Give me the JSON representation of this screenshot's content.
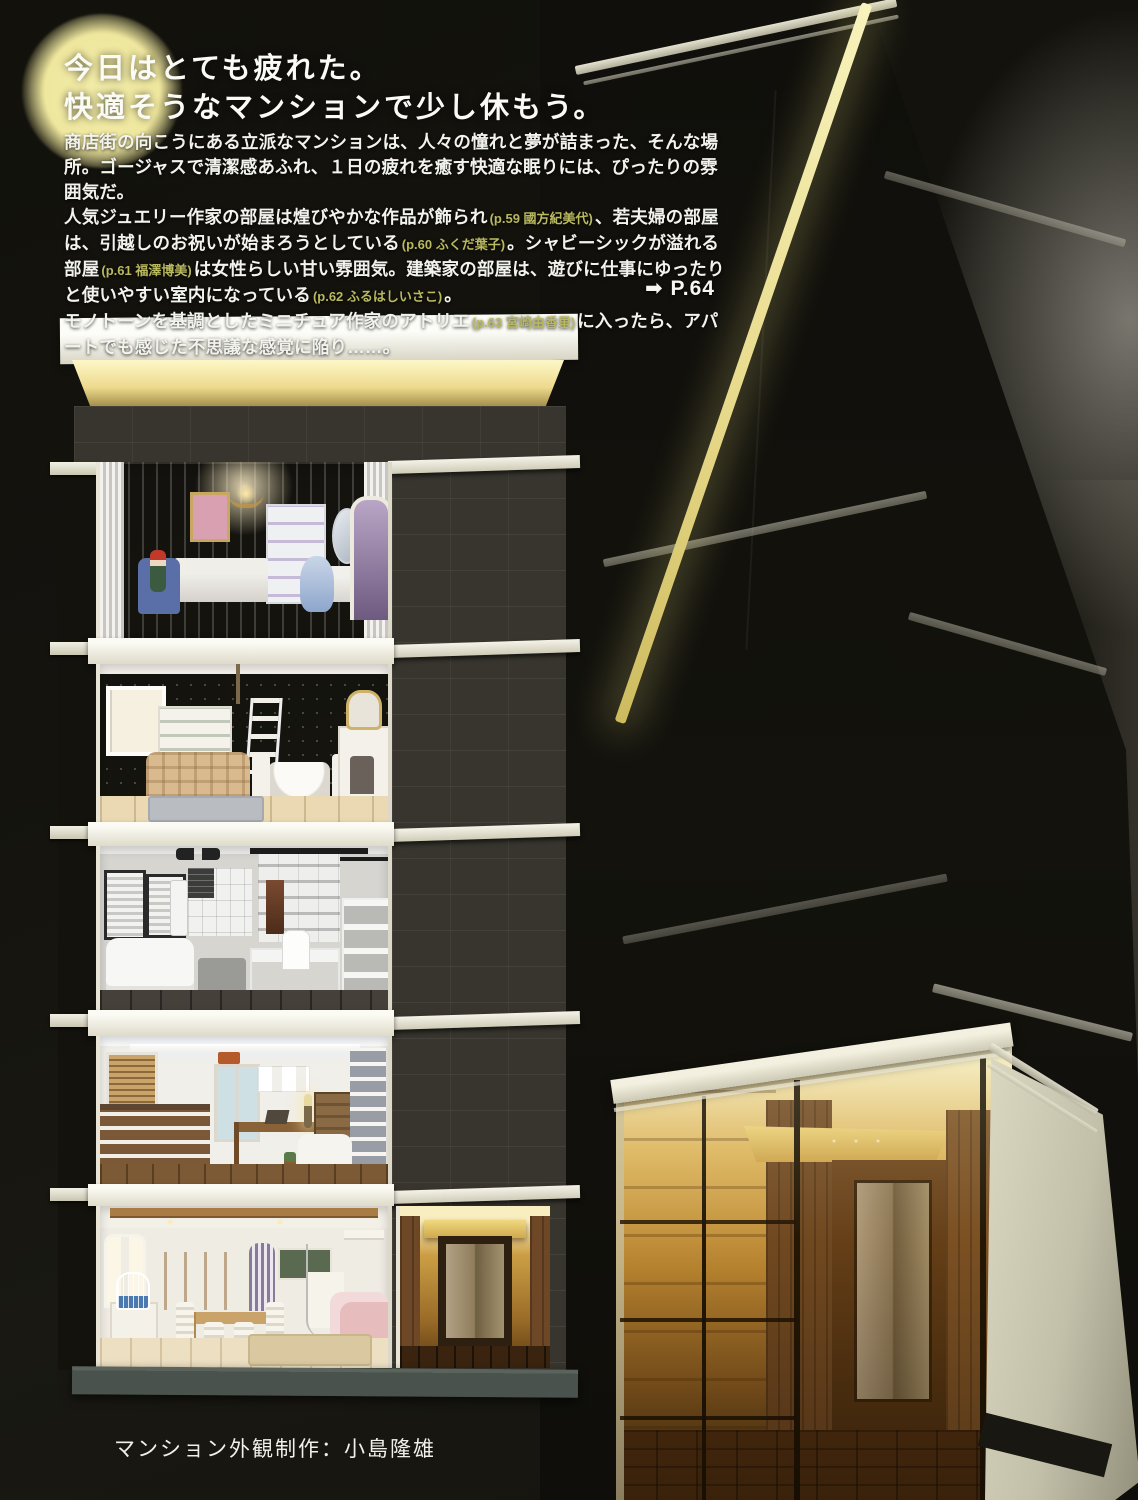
{
  "headline": {
    "line1": "今日はとても疲れた。",
    "line2": "快適そうなマンションで少し休もう。"
  },
  "intro": {
    "runs": [
      {
        "kind": "body",
        "text": "商店街の向こうにある立派なマンションは、人々の憧れと夢が詰まった、そんな場所。ゴージャスで清潔感あふれ、１日の疲れを癒す快適な眠りには、ぴったりの雰囲気だ。"
      },
      {
        "kind": "body",
        "text": "人気ジュエリー作家の部屋は煌びやかな作品が飾られ"
      },
      {
        "kind": "ref",
        "text": "(p.59 國方紀美代)"
      },
      {
        "kind": "body",
        "text": "、若夫婦の部屋は、引越しのお祝いが始まろうとしている"
      },
      {
        "kind": "ref",
        "text": "(p.60 ふくだ葉子)"
      },
      {
        "kind": "body",
        "text": "。シャビーシックが溢れる部屋"
      },
      {
        "kind": "ref",
        "text": "(p.61 福澤博美)"
      },
      {
        "kind": "body",
        "text": "は女性らしい甘い雰囲気。建築家の部屋は、遊びに仕事にゆったりと使いやすい室内になって"
      },
      {
        "kind": "body",
        "text": "いる"
      },
      {
        "kind": "ref",
        "text": "(p.62 ふるはしいさこ)"
      },
      {
        "kind": "body",
        "text": "。"
      },
      {
        "kind": "body",
        "text": "モノトーンを基調としたミニチュア作家のアトリエ"
      },
      {
        "kind": "ref",
        "text": "(p.63 宮崎由香里)"
      },
      {
        "kind": "body",
        "text": "に入ったら、アパートでも感じた不思議な感覚に陥り……。"
      }
    ]
  },
  "page_ref": {
    "arrow_glyph": "➡",
    "label": "P.64"
  },
  "caption": {
    "credit": "マンション外観制作：小島隆雄"
  },
  "colors": {
    "moon_glow": "#f1eba9",
    "ref_text": "#b9b95f",
    "cornice_white": "#efecdc",
    "stone_dark": "#37352d",
    "roof_glow": "#f6f0b4",
    "entrance_warm": "#c8913a",
    "base_slate": "#4a524c"
  }
}
